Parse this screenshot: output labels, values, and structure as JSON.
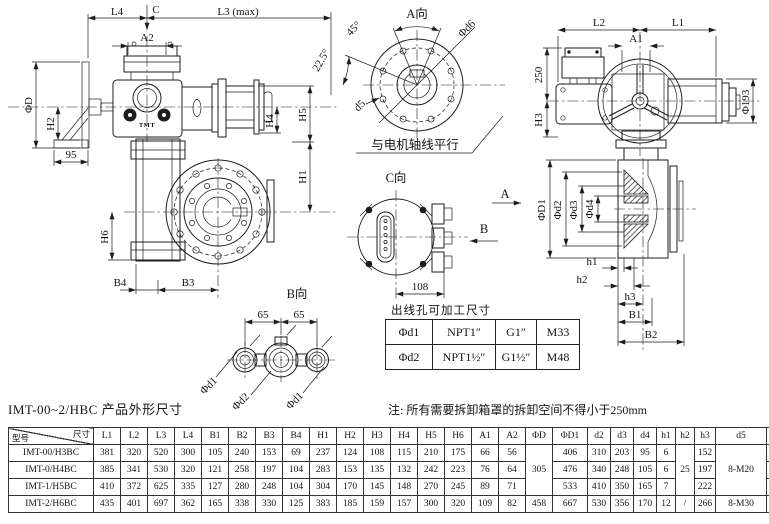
{
  "colors": {
    "ink": "#1d1d1d",
    "bg": "#ffffff"
  },
  "side_view": {
    "l4": "L4",
    "c": "C",
    "l3_max": "L3 (max)",
    "a2": "A2",
    "phi_d": "ΦD",
    "h2": "H2",
    "dim95": "95",
    "h4": "H4",
    "h5": "H5",
    "h1": "H1",
    "h6": "H6",
    "b4": "B4",
    "b3": "B3",
    "logo": "TMT"
  },
  "view_a": {
    "title": "A向",
    "phi_d6": "Φd6",
    "angle45": "45°",
    "angle225": "22.5°",
    "d5": "d5",
    "note": "与电机轴线平行"
  },
  "front_view": {
    "l2": "L2",
    "l1": "L1",
    "a1": "A1",
    "dim250": "250",
    "h3": "H3",
    "phi193": "Φ193"
  },
  "section_view": {
    "phi_d1": "ΦD1",
    "phi_d2": "Φd2",
    "phi_d3": "Φd3",
    "phi_d4": "Φd4",
    "h1": "h1",
    "h2": "h2",
    "h3": "h3",
    "b1": "B1",
    "b2": "B2",
    "arrow_a": "A"
  },
  "view_c": {
    "title": "C向",
    "arrow_b": "B",
    "dim108": "108"
  },
  "view_b": {
    "title": "B向",
    "dim65_left": "65",
    "dim65_right": "65",
    "phi_d1_left": "Φd1",
    "phi_d2": "Φd2",
    "phi_d1_right": "Φd1"
  },
  "outlet_table": {
    "title": "出线孔可加工尺寸",
    "rows": [
      [
        "Φd1",
        "NPT1″",
        "G1″",
        "M33"
      ],
      [
        "Φd2",
        "NPT1½″",
        "G1½″",
        "M48"
      ]
    ]
  },
  "caption": {
    "left": "IMT-00~2/HBC 产品外形尺寸",
    "note": "注: 所有需要拆卸箱罩的拆卸空间不得小于250mm"
  },
  "dim_table": {
    "corner_top": "尺寸",
    "corner_bottom": "型号",
    "columns": [
      "L1",
      "L2",
      "L3",
      "L4",
      "B1",
      "B2",
      "B3",
      "B4",
      "H1",
      "H2",
      "H3",
      "H4",
      "H5",
      "H6",
      "A1",
      "A2",
      "ΦD",
      "ΦD1",
      "d2",
      "d3",
      "d4",
      "h1",
      "h2",
      "h3",
      "d5",
      "d6"
    ],
    "rows": [
      {
        "model": "IMT-00/H3BC",
        "cells": [
          "381",
          "320",
          "520",
          "300",
          "105",
          "240",
          "153",
          "69",
          "237",
          "124",
          "108",
          "115",
          "210",
          "175",
          "66",
          "56",
          {
            "v": "305",
            "rs": 3
          },
          "406",
          "310",
          "203",
          "95",
          "6",
          {
            "v": "25",
            "rs": 3
          },
          "152",
          {
            "v": "8-M20",
            "rs": 3
          },
          "356"
        ]
      },
      {
        "model": "IMT-0/H4BC",
        "cells": [
          "385",
          "341",
          "530",
          "320",
          "121",
          "258",
          "197",
          "104",
          "283",
          "153",
          "135",
          "132",
          "242",
          "223",
          "76",
          "64",
          null,
          "476",
          "340",
          "248",
          "105",
          "6",
          null,
          "197",
          null,
          "406"
        ]
      },
      {
        "model": "IMT-1/H5BC",
        "cells": [
          "410",
          "372",
          "625",
          "335",
          "127",
          "280",
          "248",
          "104",
          "304",
          "170",
          "145",
          "148",
          "270",
          "245",
          "89",
          "71",
          null,
          "533",
          "410",
          "350",
          "165",
          "7",
          null,
          "222",
          null,
          "466"
        ]
      },
      {
        "model": "IMT-2/H6BC",
        "cells": [
          "435",
          "401",
          "697",
          "362",
          "165",
          "338",
          "330",
          "125",
          "383",
          "185",
          "159",
          "157",
          "300",
          "320",
          "109",
          "82",
          "458",
          "667",
          "530",
          "356",
          "170",
          "12",
          "/",
          "266",
          "8-M30",
          "584"
        ]
      }
    ]
  }
}
